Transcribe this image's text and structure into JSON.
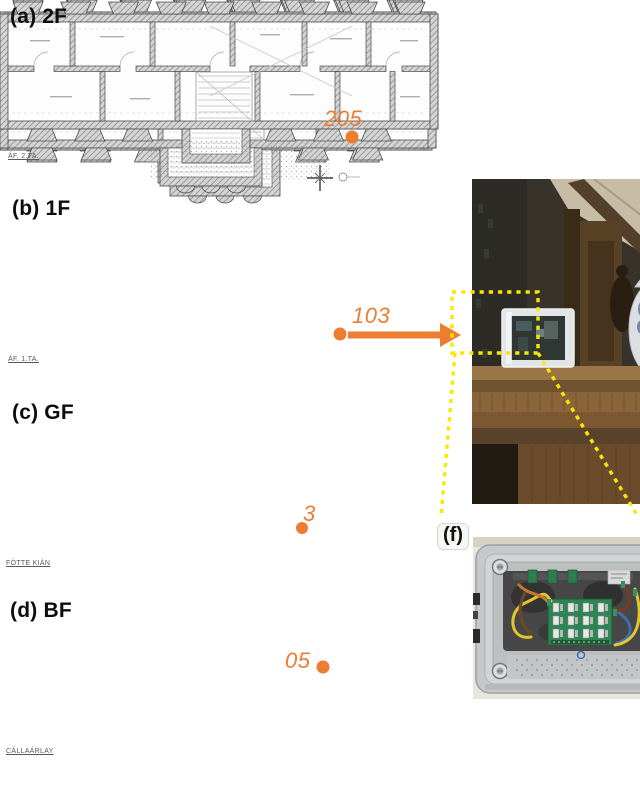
{
  "panels": [
    {
      "id": "a",
      "label": "(a) 2F",
      "floor": "2F",
      "sensor_label": "205",
      "caption": "ÁF. 2.TA."
    },
    {
      "id": "b",
      "label": "(b) 1F",
      "floor": "1F",
      "sensor_label": "103",
      "caption": "ÁF. 1.TA."
    },
    {
      "id": "c",
      "label": "(c) GF",
      "floor": "GF",
      "sensor_label": "3",
      "caption": "FÖTTE KIÁN"
    },
    {
      "id": "d",
      "label": "(d) BF",
      "floor": "BF",
      "sensor_label": "05",
      "caption": "CÁLLAÁRLAY"
    },
    {
      "id": "e",
      "label": "(e)"
    },
    {
      "id": "f",
      "label": "(f)"
    }
  ],
  "colors": {
    "sensor_accent": "#ED7D31",
    "callout_yellow": "#FFE600"
  }
}
